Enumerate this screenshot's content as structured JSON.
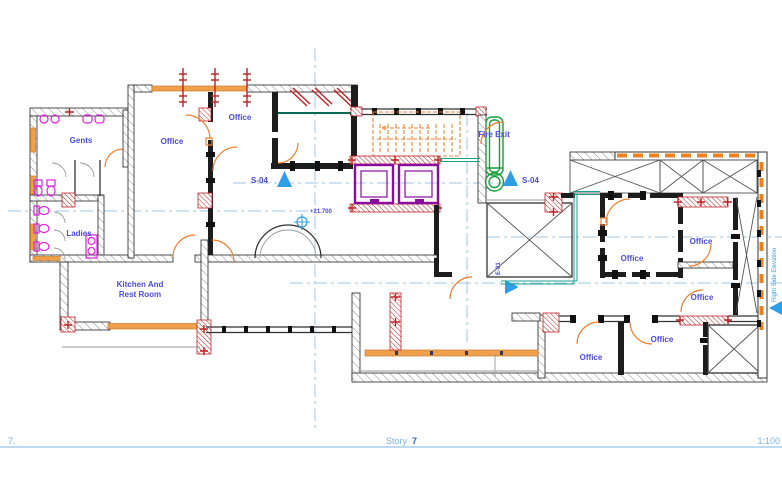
{
  "drawing": {
    "rooms": {
      "gents": "Gents",
      "ladies": "Ladies",
      "office_left": "Office",
      "office_top": "Office",
      "kitchen_line1": "Kitchen And",
      "kitchen_line2": "Rest Room",
      "office_center_right": "Office",
      "office_right_upper": "Office",
      "office_right_lower": "Office",
      "office_bottom_left": "Office",
      "office_bottom_right": "Office"
    },
    "markers": {
      "section_left": "S-04",
      "section_right": "S-04",
      "elevation_value": "+21.700",
      "fire_exit": "Fire Exit",
      "elevator_label": "E-01",
      "right_side_elevation": "Right Side Elevation"
    },
    "statusbar": {
      "left_number": "7.",
      "story_label": "Story",
      "story_number": "7",
      "scale": "1:100"
    },
    "colors": {
      "wall": "#222222",
      "hatch": "#777777",
      "window_orange": "#f0a04c",
      "door_orange": "#f08030",
      "marker_red": "#c22020",
      "fixture_magenta": "#e020e0",
      "elevator_purple": "#8a0b9e",
      "fire_escape_green": "#1a9e3c",
      "curtainwall_teal": "#18a090",
      "label_blue": "#4a4ae0",
      "marker_blue": "#2e9fe6",
      "centerline_blue": "#9cc4e4",
      "statusbar_blue": "#79b2e2",
      "statusbar_number_blue": "#2a62c8"
    }
  }
}
